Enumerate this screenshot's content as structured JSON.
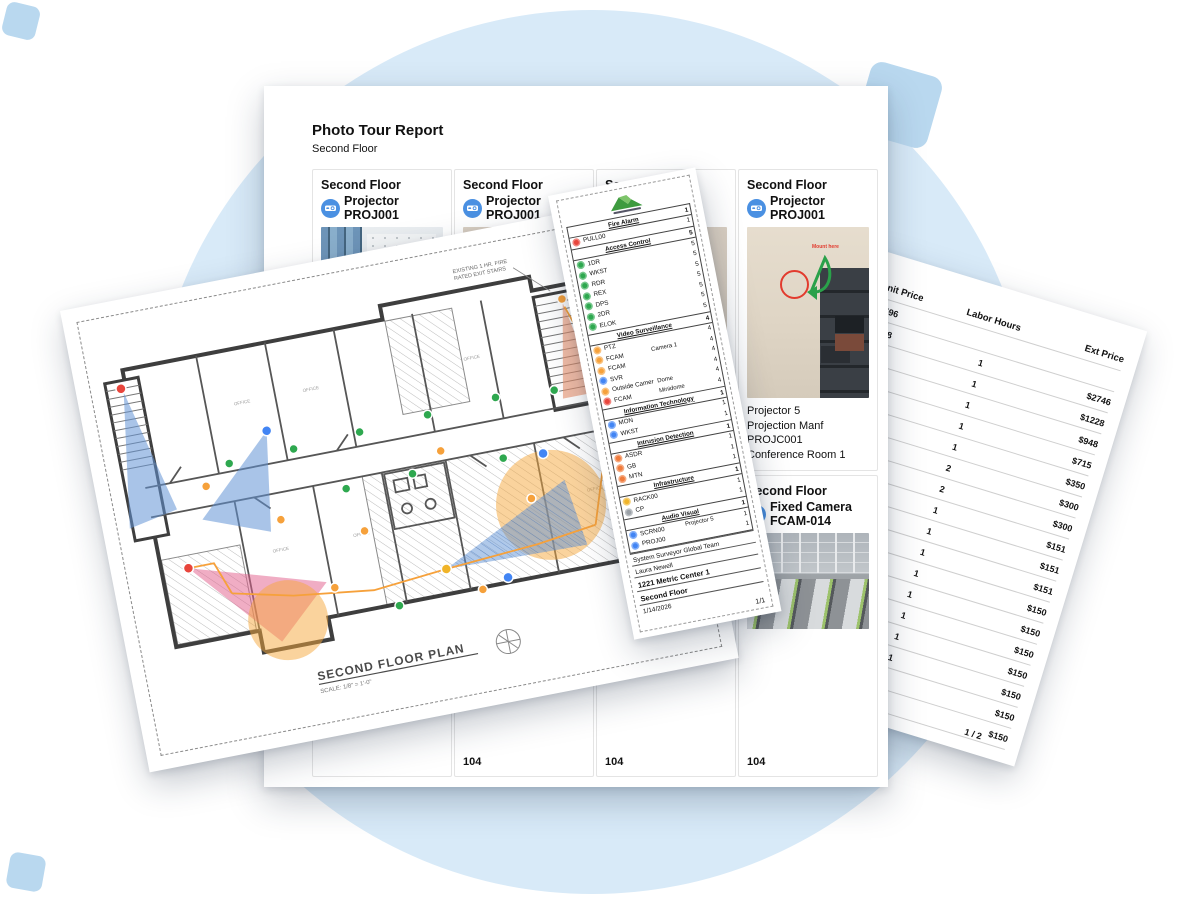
{
  "decor": {
    "circle_color": "#D8EAF8",
    "square_color": "#B9D8EF"
  },
  "photo_report": {
    "title": "Photo Tour Report",
    "subtitle": "Second Floor",
    "cards_row1": [
      {
        "floor": "Second Floor",
        "device_type": "Projector",
        "device_id": "PROJ001",
        "photo": "photo-room-a",
        "name": "",
        "manufacturer": "",
        "model": "",
        "location": ""
      },
      {
        "floor": "Second Floor",
        "device_type": "Projector",
        "device_id": "PROJ001",
        "photo": "photo-room-b",
        "name": "",
        "manufacturer": "",
        "model": "",
        "location": ""
      },
      {
        "floor": "Second Floor",
        "device_type": "Projector",
        "device_id": "PROJ001",
        "photo": "photo-room-c",
        "name": "",
        "manufacturer": "",
        "model": "",
        "location": ""
      },
      {
        "floor": "Second Floor",
        "device_type": "Projector",
        "device_id": "PROJ001",
        "photo": "photo-room-d",
        "name": "Projector 5",
        "manufacturer": "Projection Manf",
        "model": "PROJC001",
        "location": "Conference Room 1"
      }
    ],
    "cards_row2": [
      {
        "floor": "",
        "device_type": "",
        "device_id": "",
        "photo": "",
        "location": ""
      },
      {
        "floor": "",
        "device_type": "",
        "device_id": "",
        "photo": "",
        "location": "104"
      },
      {
        "floor": "",
        "device_type": "",
        "device_id": "",
        "photo": "",
        "location": "104"
      },
      {
        "floor": "Second Floor",
        "device_type": "Fixed Camera",
        "device_id": "FCAM-014",
        "photo": "photo-office",
        "location": "104"
      }
    ],
    "photo_annotation": "Mount here"
  },
  "floor_plan": {
    "title": "SECOND FLOOR PLAN",
    "scale": "SCALE: 1/8\" = 1'-0\"",
    "note_line1": "EXISTING 1 HR. FIRE",
    "note_line2": "RATED EXIT STAIRS",
    "room_label": "OFFICE"
  },
  "schedule": {
    "sections": [
      {
        "name": "Fire Alarm",
        "count": "1",
        "items": [
          {
            "label": "PULL00",
            "detail": "",
            "count": "1",
            "color": "#E8453C"
          }
        ]
      },
      {
        "name": "Access Control",
        "count": "5",
        "items": [
          {
            "label": "1DR",
            "detail": "",
            "count": "1",
            "color": "#2EA84F"
          },
          {
            "label": "WKST",
            "detail": "",
            "count": "3",
            "color": "#2EA84F"
          },
          {
            "label": "RDR",
            "detail": "",
            "count": "1",
            "color": "#2EA84F"
          },
          {
            "label": "REX",
            "detail": "",
            "count": "1",
            "color": "#2EA84F"
          },
          {
            "label": "DPS",
            "detail": "",
            "count": "1",
            "color": "#2EA84F"
          },
          {
            "label": "2DR",
            "detail": "",
            "count": "2",
            "color": "#2EA84F"
          },
          {
            "label": "ELOK",
            "detail": "",
            "count": "3",
            "color": "#2EA84F"
          }
        ]
      },
      {
        "name": "Video Surveillance",
        "count": "4",
        "items": [
          {
            "label": "PTZ",
            "detail": "",
            "count": "1",
            "color": "#F6A13B"
          },
          {
            "label": "FCAM",
            "detail": "Camera 1",
            "count": "1",
            "color": "#F6A13B"
          },
          {
            "label": "FCAM",
            "detail": "",
            "count": "1",
            "color": "#F6A13B"
          },
          {
            "label": "SVR",
            "detail": "",
            "count": "1",
            "color": "#4285F4"
          },
          {
            "label": "Outside Camer",
            "detail": "Dome",
            "count": "1",
            "color": "#F6A13B"
          },
          {
            "label": "FCAM",
            "detail": "Minidome",
            "count": "1",
            "color": "#E8453C"
          }
        ]
      },
      {
        "name": "Information Technology",
        "count": "1",
        "items": [
          {
            "label": "MON",
            "detail": "",
            "count": "1",
            "color": "#4285F4"
          },
          {
            "label": "WKST",
            "detail": "",
            "count": "1",
            "color": "#4285F4"
          }
        ]
      },
      {
        "name": "Intrusion Detection",
        "count": "1",
        "items": [
          {
            "label": "ASDR",
            "detail": "",
            "count": "1",
            "color": "#F07B3C"
          },
          {
            "label": "GB",
            "detail": "",
            "count": "1",
            "color": "#F07B3C"
          },
          {
            "label": "MTN",
            "detail": "",
            "count": "1",
            "color": "#F07B3C"
          }
        ]
      },
      {
        "name": "Infrastructure",
        "count": "1",
        "items": [
          {
            "label": "RACK00",
            "detail": "",
            "count": "1",
            "color": "#F0B429"
          },
          {
            "label": "CP",
            "detail": "",
            "count": "2",
            "color": "#9AA0A6"
          }
        ]
      },
      {
        "name": "Audio Visual",
        "count": "1",
        "items": [
          {
            "label": "SCRN00",
            "detail": "Projector 5",
            "count": "1",
            "color": "#4285F4"
          },
          {
            "label": "PROJ00",
            "detail": "",
            "count": "1",
            "color": "#4285F4"
          }
        ]
      }
    ],
    "footer": {
      "team": "System Surveyor Global Team",
      "user": "Laura Newell",
      "site": "1221 Metric Center 1",
      "floor": "Second Floor",
      "date": "1/14/2026",
      "page": "1/1"
    }
  },
  "price_sheet": {
    "col_unit": "Unit Price",
    "col_hours": "Labor Hours",
    "col_ext": "Ext Price",
    "rows": [
      {
        "unit": "$2596",
        "hours": "",
        "ext": ""
      },
      {
        "unit": "$1078",
        "hours": "1",
        "ext": "$2746"
      },
      {
        "unit": "$796",
        "hours": "1",
        "ext": "$1228"
      },
      {
        "unit": "$1665",
        "hours": "1",
        "ext": "$948"
      },
      {
        "unit": "00",
        "hours": "1",
        "ext": "$715"
      },
      {
        "unit": "",
        "hours": "1",
        "ext": "$350"
      },
      {
        "unit": "",
        "hours": "2",
        "ext": "$300"
      },
      {
        "unit": "",
        "hours": "2",
        "ext": "$300"
      },
      {
        "unit": "",
        "hours": "1",
        "ext": "$151"
      },
      {
        "unit": "",
        "hours": "1",
        "ext": "$151"
      },
      {
        "unit": "",
        "hours": "1",
        "ext": "$151"
      },
      {
        "unit": "",
        "hours": "1",
        "ext": "$150"
      },
      {
        "unit": "",
        "hours": "1",
        "ext": "$150"
      },
      {
        "unit": "",
        "hours": "1",
        "ext": "$150"
      },
      {
        "unit": "",
        "hours": "1",
        "ext": "$150"
      },
      {
        "unit": "",
        "hours": "1",
        "ext": "$150"
      },
      {
        "unit": "",
        "hours": "",
        "ext": "$150"
      },
      {
        "unit": "",
        "hours": "",
        "ext": "$150"
      }
    ],
    "page": "1 / 2"
  }
}
